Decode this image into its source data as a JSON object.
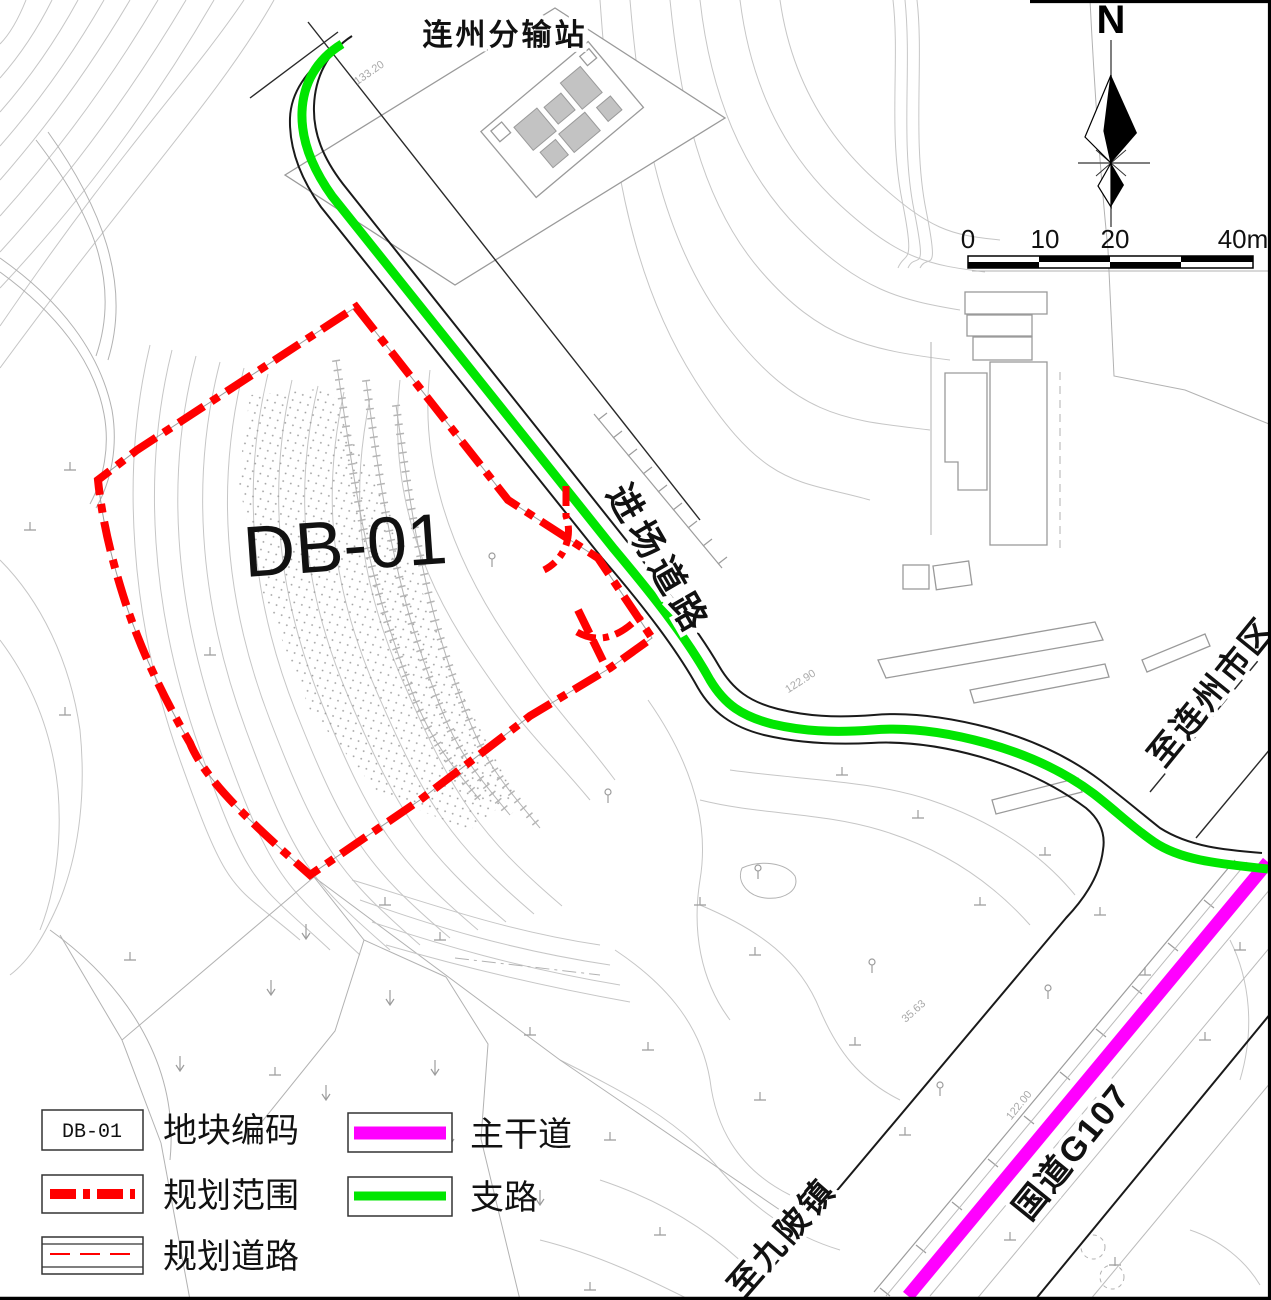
{
  "map": {
    "station_label": "连州分输站",
    "plot_code": "DB-01",
    "labels": {
      "access_road": "进场道路",
      "to_lianzhou_city": "至连州市区",
      "to_jiupo_town": "至九陂镇",
      "g107": "国道G107"
    },
    "contour_labels": {
      "c1": "133.20",
      "c2": "122.90",
      "c3": "122.00",
      "c4": "35.63"
    },
    "compass_north": "N",
    "scale_bar": {
      "tick0": "0",
      "tick10": "10",
      "tick20": "20",
      "tick40": "40m"
    },
    "colors": {
      "planning_boundary": "#ff0000",
      "main_road": "#ff00ff",
      "branch_road": "#00e600",
      "contour": "#c6c6c6"
    }
  },
  "legend": {
    "plot_code": {
      "sample": "DB-01",
      "label": "地块编码"
    },
    "planning_boundary": {
      "label": "规划范围"
    },
    "planned_road": {
      "label": "规划道路"
    },
    "main_road": {
      "label": "主干道"
    },
    "branch_road": {
      "label": "支路"
    }
  }
}
